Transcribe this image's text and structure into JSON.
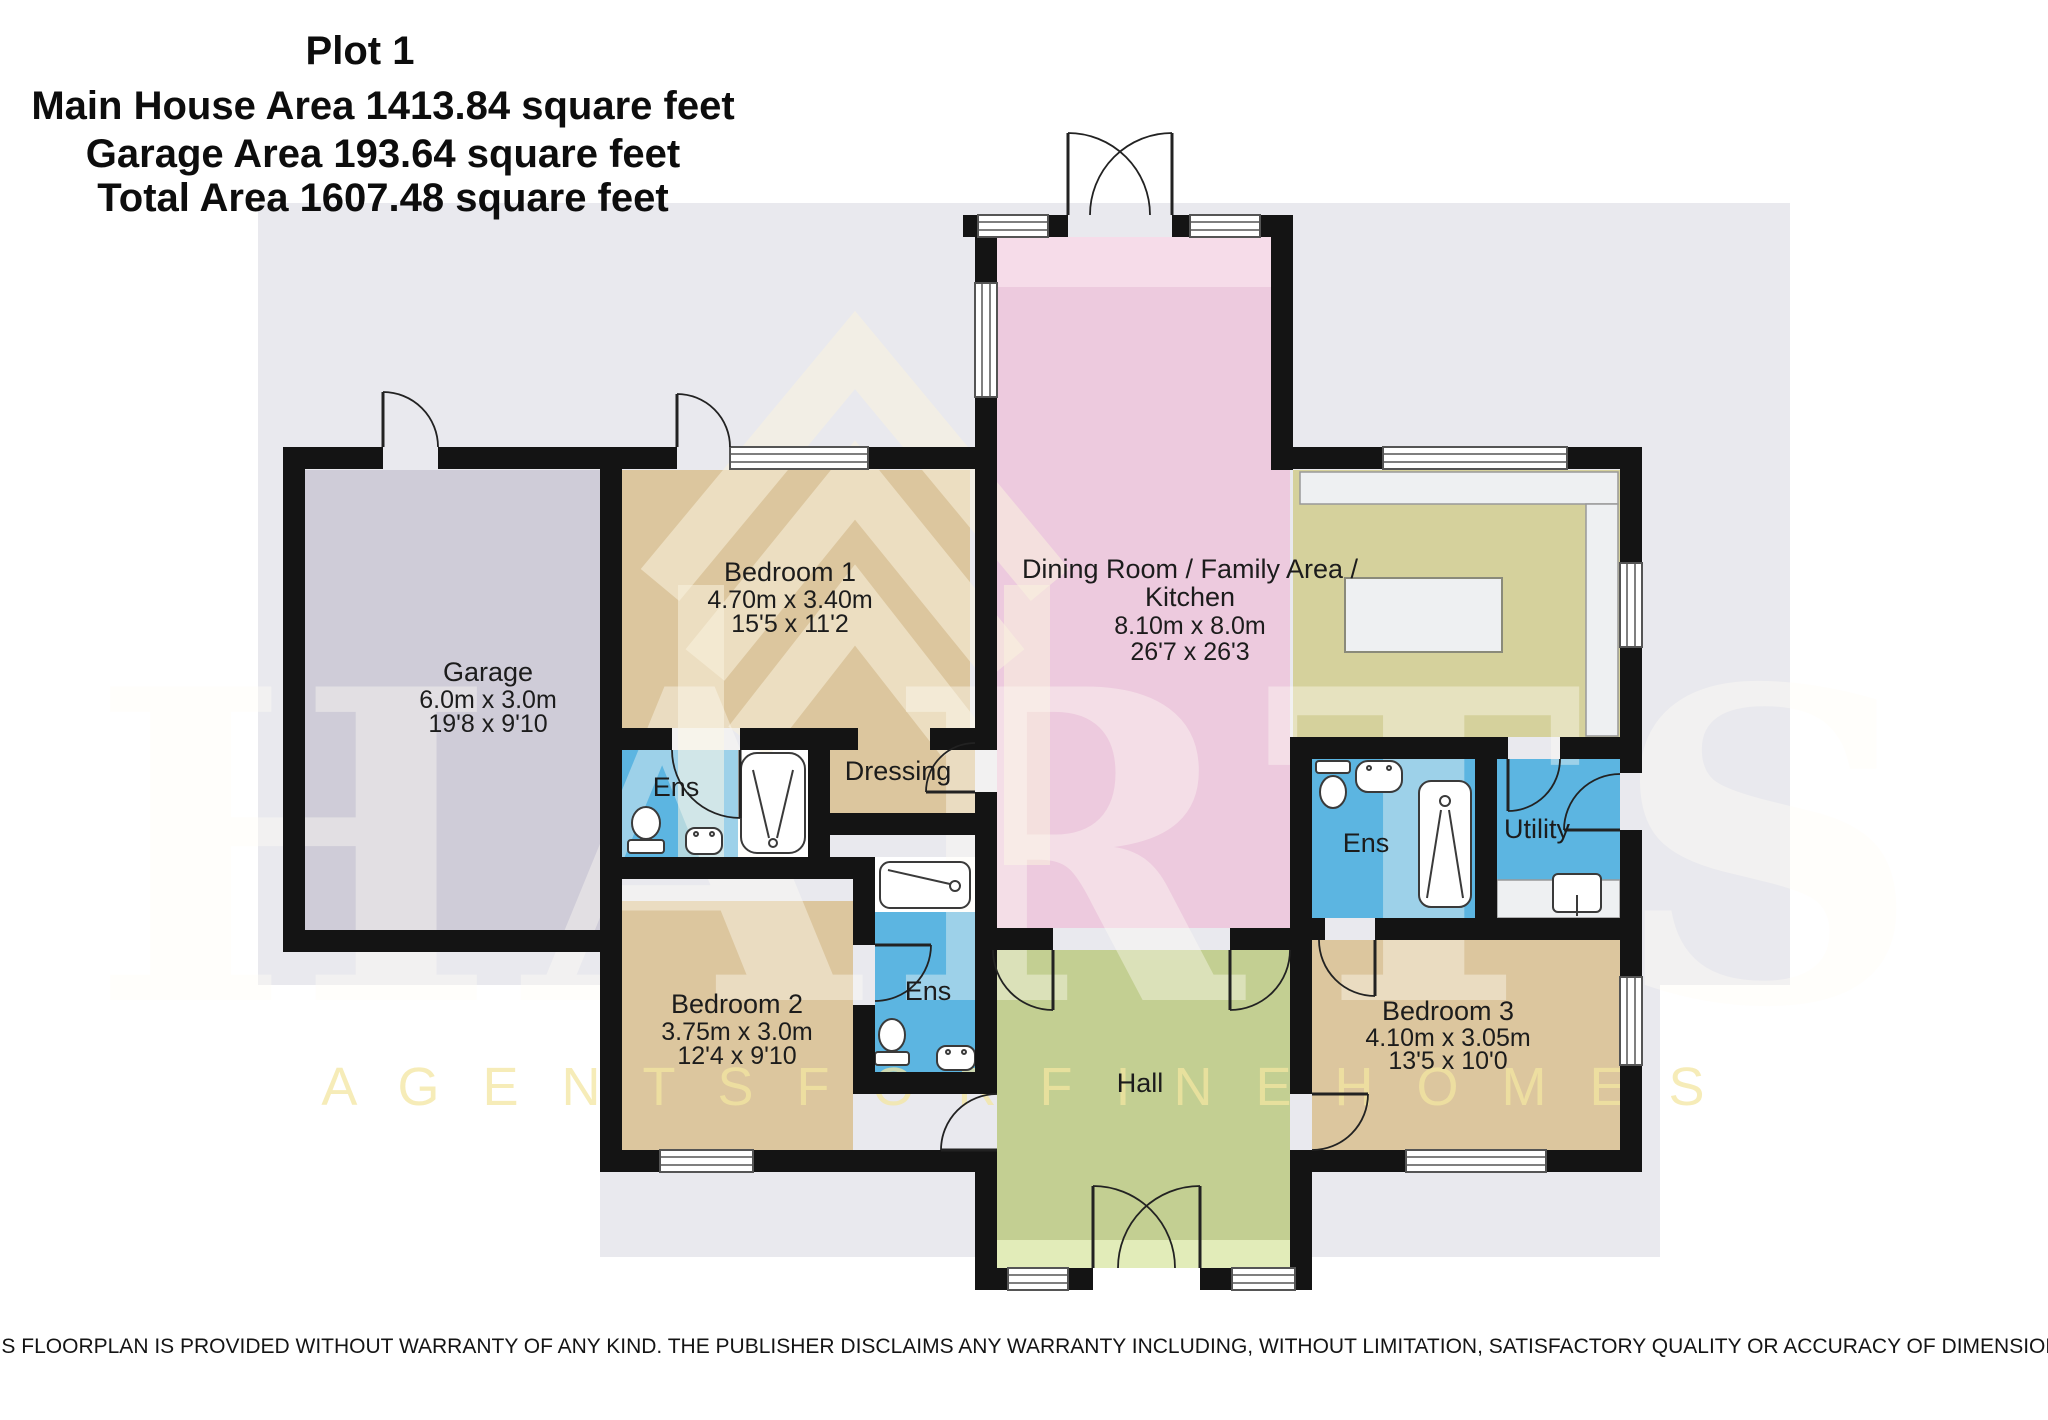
{
  "title": {
    "plot": "Plot 1",
    "main_house_area": "Main House Area 1413.84 square feet",
    "garage_area": "Garage Area 193.64 square feet",
    "total_area": "Total Area 1607.48 square feet"
  },
  "rooms": {
    "garage": {
      "name": "Garage",
      "metric": "6.0m x 3.0m",
      "imperial": "19'8 x 9'10"
    },
    "bedroom1": {
      "name": "Bedroom 1",
      "metric": "4.70m x 3.40m",
      "imperial": "15'5 x 11'2"
    },
    "bedroom2": {
      "name": "Bedroom 2",
      "metric": "3.75m x 3.0m",
      "imperial": "12'4 x 9'10"
    },
    "bedroom3": {
      "name": "Bedroom 3",
      "metric": "4.10m x 3.05m",
      "imperial": "13'5 x 10'0"
    },
    "dining": {
      "name": "Dining Room / Family Area /",
      "name2": "Kitchen",
      "metric": "8.10m x 8.0m",
      "imperial": "26'7 x 26'3"
    },
    "hall": {
      "name": "Hall"
    },
    "ens1": {
      "name": "Ens"
    },
    "ens2": {
      "name": "Ens"
    },
    "ens3": {
      "name": "Ens"
    },
    "dressing": {
      "name": "Dressing"
    },
    "utility": {
      "name": "Utility"
    }
  },
  "watermark": {
    "brand": "HARTS",
    "tagline": "A G E N T S   F O R   F I N E   H O M E S"
  },
  "disclaimer": "THIS FLOORPLAN IS PROVIDED WITHOUT WARRANTY OF ANY KIND. THE PUBLISHER DISCLAIMS ANY WARRANTY INCLUDING, WITHOUT LIMITATION, SATISFACTORY QUALITY OR ACCURACY OF DIMENSIONS.",
  "colors": {
    "plot": "#e9e9ee",
    "wall": "#141414",
    "garage": "#cfccd8",
    "tan": "#dcc69e",
    "pink": "#edcade",
    "pinkLight": "#f6dce9",
    "olive": "#d5d19c",
    "green": "#c3cf92",
    "greenLight": "#e2ecb9",
    "blue": "#5cb5e1",
    "white": "#ffffff",
    "counter": "#eef0f2",
    "fixtureStroke": "#3a3a3a",
    "doorStroke": "#222222"
  }
}
